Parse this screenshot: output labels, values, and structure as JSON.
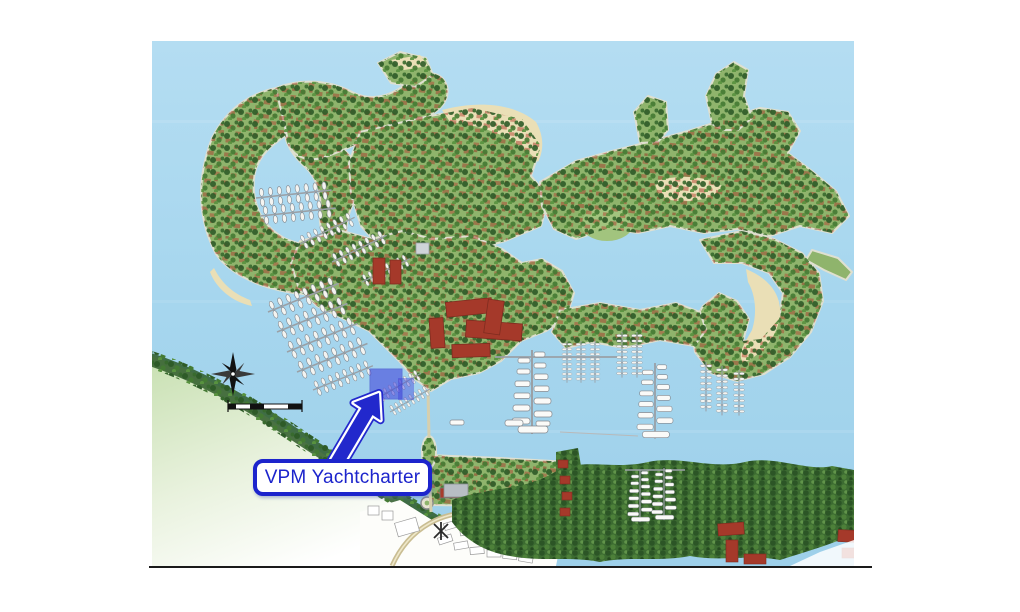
{
  "page": {
    "background_color": "#ffffff"
  },
  "map": {
    "name": "resort-marina-site-plan",
    "annotation": {
      "label": "VPM Yachtcharter",
      "text_color": "#1c24cc",
      "box_border_color": "#1c24cc",
      "box_fill_color": "#ffffff",
      "arrow_color": "#2228cc",
      "highlight_fill_color": "#3a3ada"
    },
    "colors": {
      "water": "#a9d8ef",
      "island_green": "#8fb46c",
      "tree_green": "#2e5b28",
      "beach_sand": "#eadfb6",
      "roof_red": "#a83c2c",
      "dock_gray": "#9aa0a6",
      "bottom_border_line": "#1a1a1a"
    },
    "icons": [
      "compass-rose-icon",
      "scale-bar-icon"
    ]
  }
}
